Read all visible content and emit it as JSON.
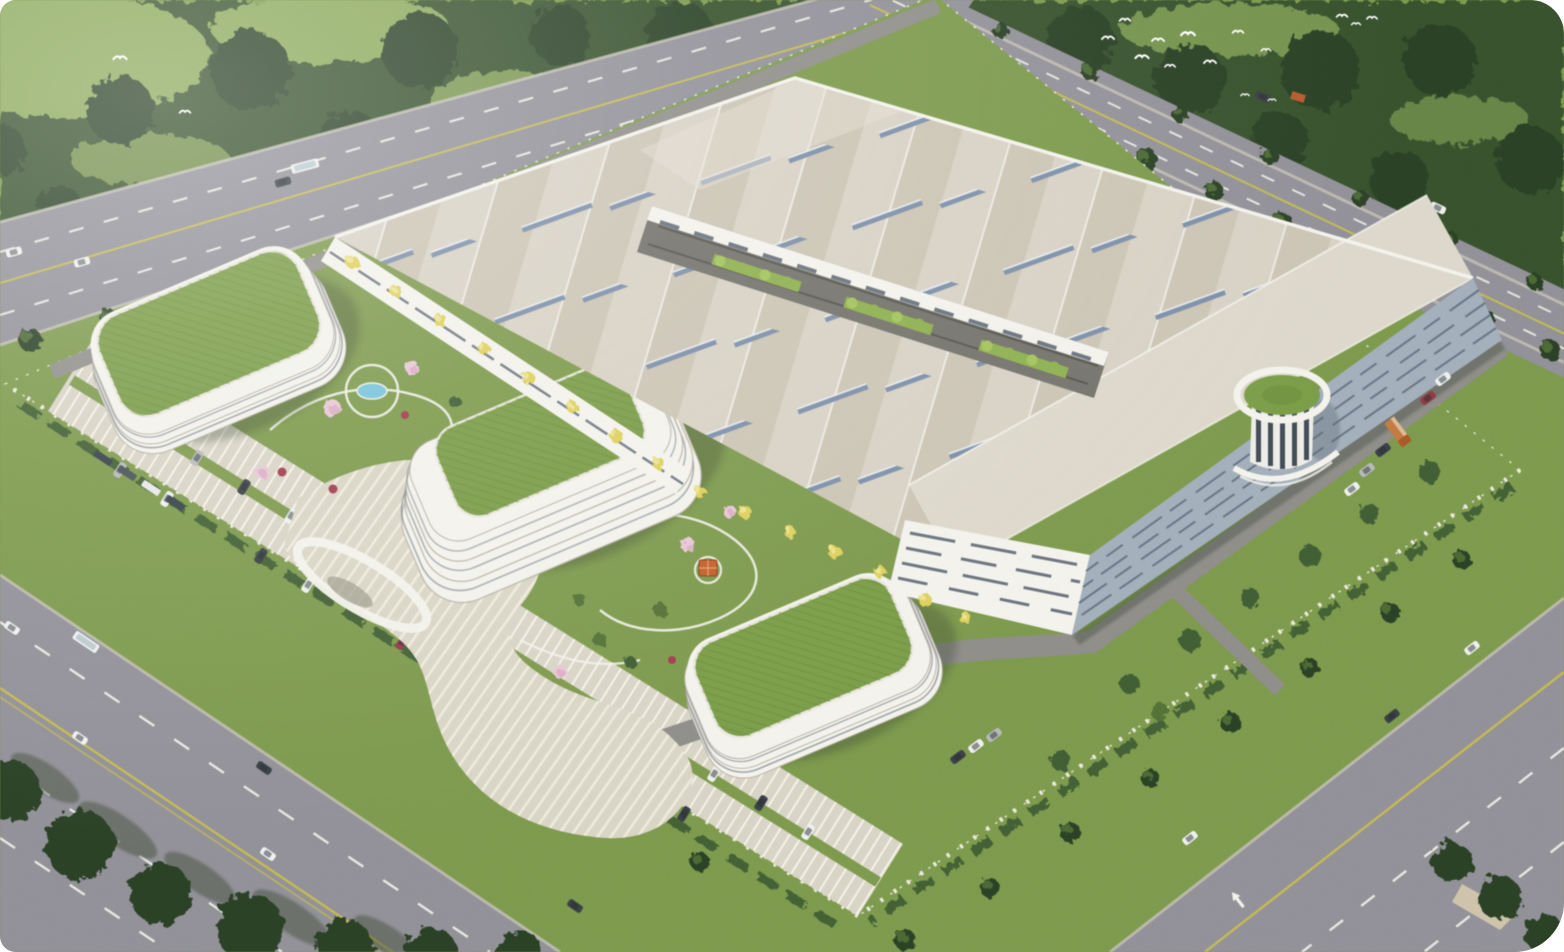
{
  "scene": {
    "title": "Aerial rendering of an industrial campus",
    "description": "Bird's-eye architectural rendering: a huge light-roofed factory hall with rows of blue skylights and a tree-lined inner courtyard, a striped cylindrical tower with a round green roof on its east face, three curved white office buildings with planted green roofs, terraced stair plaza, landscaped gardens with a pool and an orange-roofed gazebo, striped surface parking full of cars, a fenced perimeter, tree-lined boulevards with traffic on three sides, dense forest along the top, and a flock of white birds.",
    "landmarks": [
      "factory-hall",
      "factory-courtyard",
      "round-green-tower",
      "office-building-nw",
      "office-building-center-terraced",
      "office-building-south",
      "garden-pool",
      "gazebo",
      "stepped-plaza",
      "parking-lot",
      "perimeter-fence",
      "boulevards",
      "forest",
      "bird-flock"
    ],
    "counts": {
      "green_roof_buildings": 3,
      "birds": 16,
      "vehicles_on_roads": 15,
      "parked_vehicles": 28,
      "courtyard_planters": 3
    }
  },
  "palette": {
    "grass": "#7e994f",
    "meadow": "#8ba85c",
    "forest": "#38512f",
    "canopy": "#2c4026",
    "treelight": "#557137",
    "road": "#929198",
    "curb": "#c6c2b6",
    "mark": "#f2f2ea",
    "yline": "#c4ba55",
    "parking": "#d8d4c7",
    "stall": "#f4f2e8",
    "plaza": "#d9d5c7",
    "step": "#f0ede1",
    "white": "#f3f2ec",
    "bandline": "#b7b2a6",
    "facaded": "#5b6572",
    "roof": "#d8d2c6",
    "roofband": "#b0a694",
    "apron": "#ddd8cc",
    "skylight": "#7e90a9",
    "greenroof": "#7c9c4a",
    "turfline": "#67883c",
    "courtyard": "#74736c",
    "planter": "#8fb052",
    "pool": "#7cc4d9",
    "blossom": "#e7c7d4",
    "redshrub": "#a13c4c",
    "ytree": "#ddd05e",
    "gazebo": "#c2602e",
    "hedge": "#415d36",
    "shadow": "#3c4836",
    "eastwall": "#a3aeba",
    "streak": "#5f6b7a",
    "truck": "#c07a42",
    "carwhite": "#eef0ef",
    "cardark": "#3a4046",
    "carsilver": "#b6b9bc",
    "carred": "#8e3a45"
  }
}
